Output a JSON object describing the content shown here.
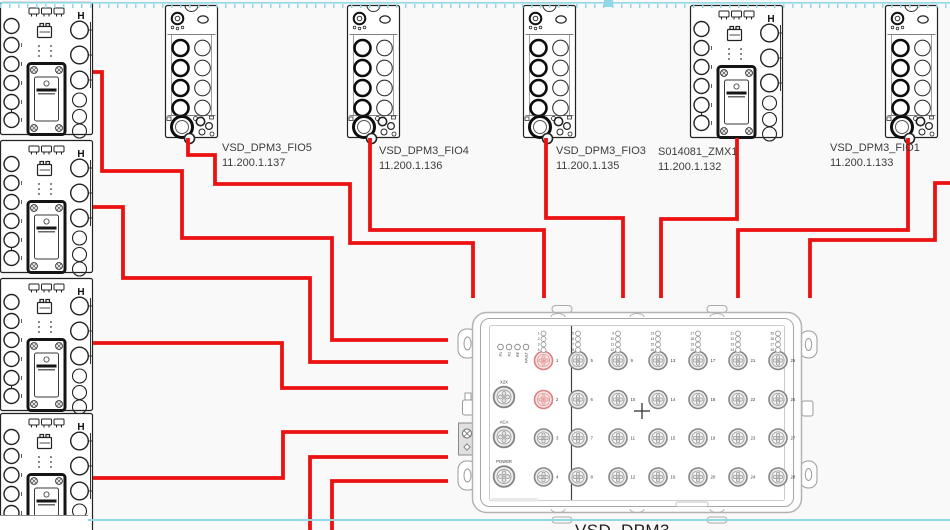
{
  "diagram": {
    "background": "#f9f9f9",
    "wire_color": "#ec1212",
    "wire_width": 3.8,
    "marquee_color": "#92d8e8",
    "left_module_glyph": "H"
  },
  "top_devices": [
    {
      "id": "fio5",
      "name": "VSD_DPM3_FIO5",
      "ip": "11.200.1.137",
      "style": "fio",
      "x": 165,
      "y": 5,
      "label_x": 222,
      "label_y": 141
    },
    {
      "id": "fio4",
      "name": "VSD_DPM3_FIO4",
      "ip": "11.200.1.136",
      "style": "fio",
      "x": 347,
      "y": 5,
      "label_x": 379,
      "label_y": 144
    },
    {
      "id": "fio3",
      "name": "VSD_DPM3_FIO3",
      "ip": "11.200.1.135",
      "style": "fio",
      "x": 523,
      "y": 5,
      "label_x": 556,
      "label_y": 144
    },
    {
      "id": "zmx1",
      "name": "S014081_ZMX1",
      "ip": "11.200.1.132",
      "style": "zmx",
      "x": 690,
      "y": 5,
      "label_x": 658,
      "label_y": 145
    },
    {
      "id": "fio1",
      "name": "VSD_DPM3_FIO1",
      "ip": "11.200.1.133",
      "style": "fio",
      "x": 885,
      "y": 5,
      "label_x": 830,
      "label_y": 141
    }
  ],
  "left_modules": [
    {
      "id": "left-io-module-1",
      "y": 2
    },
    {
      "id": "left-io-module-2",
      "y": 140
    },
    {
      "id": "left-io-module-3",
      "y": 278
    },
    {
      "id": "left-io-module-4",
      "y": 413
    }
  ],
  "main_device": {
    "name": "VSD_DPM3",
    "label_x": 575,
    "label_y": 521,
    "status_leds": [
      "P1",
      "P2",
      "RE",
      "FAULT"
    ],
    "side_port_labels": [
      "X2X",
      "ACA",
      "POWER"
    ],
    "front_ports_col1": [
      1,
      2,
      3,
      4
    ],
    "highlighted_ports": [
      1,
      2
    ],
    "port_columns": [
      [
        5,
        6,
        7,
        8
      ],
      [
        9,
        10,
        11,
        12
      ],
      [
        13,
        14,
        15,
        16
      ],
      [
        17,
        18,
        19,
        20
      ],
      [
        21,
        22,
        23,
        24
      ],
      [
        25,
        26,
        27,
        28
      ]
    ]
  },
  "wires": [
    {
      "id": "left1-to-main",
      "points": [
        [
          93,
          72
        ],
        [
          102,
          72
        ],
        [
          102,
          171
        ],
        [
          182,
          171
        ],
        [
          182,
          238
        ],
        [
          332,
          238
        ],
        [
          332,
          340
        ],
        [
          448,
          340
        ]
      ]
    },
    {
      "id": "left2-to-main",
      "points": [
        [
          93,
          207
        ],
        [
          123,
          207
        ],
        [
          123,
          278
        ],
        [
          310,
          278
        ],
        [
          310,
          362
        ],
        [
          448,
          362
        ]
      ]
    },
    {
      "id": "left3-to-main",
      "points": [
        [
          93,
          343
        ],
        [
          282,
          343
        ],
        [
          282,
          388
        ],
        [
          448,
          388
        ]
      ]
    },
    {
      "id": "left4-to-main",
      "points": [
        [
          93,
          478
        ],
        [
          283,
          478
        ],
        [
          283,
          432
        ],
        [
          448,
          432
        ]
      ]
    },
    {
      "id": "bottom1-to-main",
      "points": [
        [
          310,
          532
        ],
        [
          310,
          457
        ],
        [
          448,
          457
        ]
      ]
    },
    {
      "id": "bottom2-to-main",
      "points": [
        [
          332,
          532
        ],
        [
          332,
          481
        ],
        [
          448,
          481
        ]
      ]
    },
    {
      "id": "fio5-to-main",
      "points": [
        [
          188,
          138
        ],
        [
          188,
          155
        ],
        [
          215,
          155
        ],
        [
          215,
          184
        ],
        [
          350,
          184
        ],
        [
          350,
          243
        ],
        [
          473,
          243
        ],
        [
          473,
          298
        ]
      ]
    },
    {
      "id": "fio4-to-main",
      "points": [
        [
          370,
          138
        ],
        [
          370,
          230
        ],
        [
          544,
          230
        ],
        [
          544,
          298
        ]
      ]
    },
    {
      "id": "fio3-to-main",
      "points": [
        [
          546,
          138
        ],
        [
          546,
          218
        ],
        [
          623,
          218
        ],
        [
          623,
          298
        ]
      ]
    },
    {
      "id": "zmx1-to-main",
      "points": [
        [
          737,
          138
        ],
        [
          737,
          219
        ],
        [
          661,
          219
        ],
        [
          661,
          298
        ]
      ]
    },
    {
      "id": "fio1-to-main",
      "points": [
        [
          908,
          138
        ],
        [
          908,
          230
        ],
        [
          738,
          230
        ],
        [
          738,
          298
        ]
      ]
    },
    {
      "id": "right-edge-to-main",
      "points": [
        [
          952,
          183
        ],
        [
          935,
          183
        ],
        [
          935,
          240
        ],
        [
          810,
          240
        ],
        [
          810,
          298
        ]
      ]
    }
  ]
}
